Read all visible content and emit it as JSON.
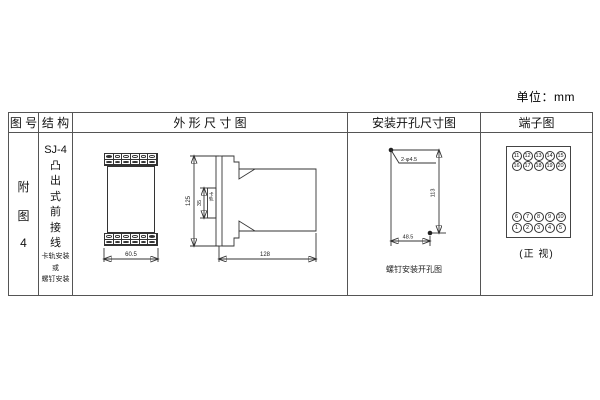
{
  "unit_label": "单位：mm",
  "table_headers": {
    "col1": "图 号",
    "col2": "结 构",
    "col3": "外 形 尺 寸 图",
    "col4": "安装开孔尺寸图",
    "col5": "端子图"
  },
  "figure": {
    "line1": "附",
    "line2": "图",
    "line3": "4"
  },
  "structure": {
    "model": "SJ-4",
    "type_vertical": "凸出式前接线",
    "mount_line1": "卡轨安装",
    "mount_line2": "或",
    "mount_line3": "螺钉安装"
  },
  "outline": {
    "front_width": "60.5",
    "side_height": "125",
    "rail_height": "35",
    "rail_label": "卡轨",
    "side_depth": "128"
  },
  "mounting": {
    "holes_label": "2-φ4.5",
    "vertical_dim": "113",
    "horizontal_dim": "48.5",
    "caption": "螺钉安装开孔图"
  },
  "terminals": {
    "top_rows": [
      [
        "11",
        "12",
        "13",
        "14",
        "15"
      ],
      [
        "16",
        "17",
        "18",
        "19",
        "20"
      ]
    ],
    "bottom_rows": [
      [
        "6",
        "7",
        "8",
        "9",
        "10"
      ],
      [
        "1",
        "2",
        "3",
        "4",
        "5"
      ]
    ],
    "caption": "(正 视)"
  },
  "colors": {
    "line": "#333333",
    "border": "#555555",
    "background": "#ffffff"
  }
}
